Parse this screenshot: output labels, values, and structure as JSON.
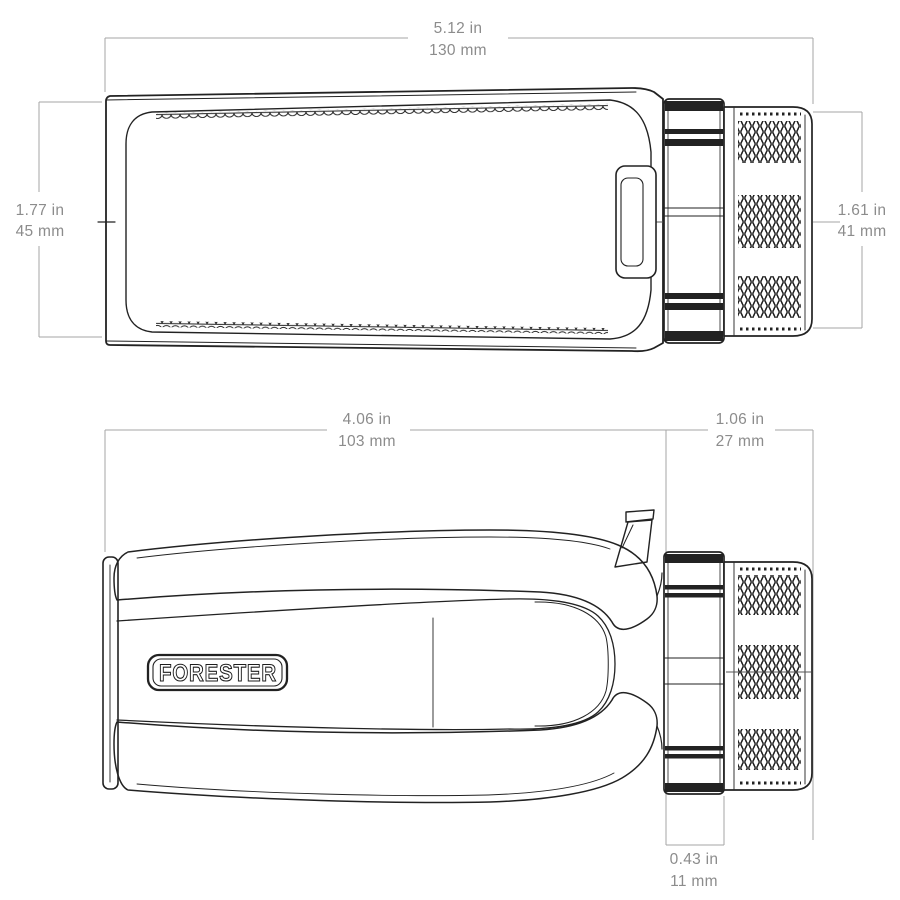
{
  "brand_label": "FORESTER",
  "colors": {
    "outline": "#222222",
    "dimension_lines": "#a6a6a6",
    "dimension_text": "#8c8c8c",
    "background": "#ffffff"
  },
  "dimensions": {
    "top_view": {
      "overall_length": {
        "inches": "5.12 in",
        "metric": "130 mm"
      },
      "body_height": {
        "inches": "1.77 in",
        "metric": "45 mm"
      },
      "eyepiece_height": {
        "inches": "1.61 in",
        "metric": "41 mm"
      }
    },
    "side_view": {
      "body_length": {
        "inches": "4.06 in",
        "metric": "103 mm"
      },
      "eyepiece_assembly_length": {
        "inches": "1.06 in",
        "metric": "27 mm"
      },
      "focus_ring_width": {
        "inches": "0.43 in",
        "metric": "11 mm"
      }
    }
  }
}
